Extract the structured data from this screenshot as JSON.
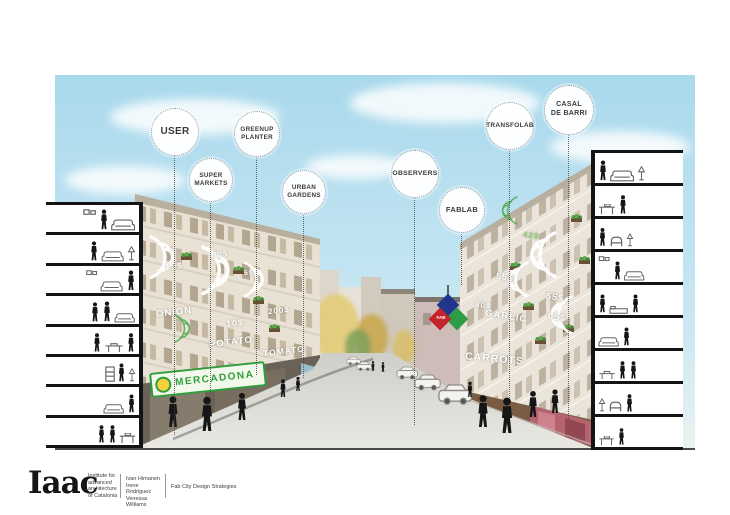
{
  "annotations": [
    {
      "label": "USER"
    },
    {
      "label": "SUPER\nMARKETS"
    },
    {
      "label": "GREENUP\nPLANTER"
    },
    {
      "label": "URBAN\nGARDENS"
    },
    {
      "label": "OBSERVERS"
    },
    {
      "label": "FABLAB"
    },
    {
      "label": "TRANSFOLAB"
    },
    {
      "label": "CASAL\nDE BARRI"
    }
  ],
  "scene": {
    "left_building_tags": [
      "10$",
      "80$",
      "5$",
      "ONION",
      "10$",
      "200$",
      "POTATO",
      "TOMATO"
    ],
    "right_building_tags": [
      "42$",
      "55$",
      "80$",
      "GARLIC",
      "55$",
      "05$",
      "CARROTS"
    ],
    "market_sign": "MERCADONA",
    "fablab_logo_text": "FAB"
  },
  "footer": {
    "logo": "Iaac",
    "org": "Institute for\nadvanced\narchitecture\nof Catalonia",
    "authors": "Ivan Himanen\nIrene Rodriguez\nVenessa Williams",
    "project": "Fab City Design Strategies"
  },
  "colors": {
    "sky": "#aedcec",
    "accent_green": "#2f9e3a",
    "fablab_blue": "#20368c",
    "fablab_red": "#c5232c",
    "fablab_green": "#2e9c46"
  }
}
